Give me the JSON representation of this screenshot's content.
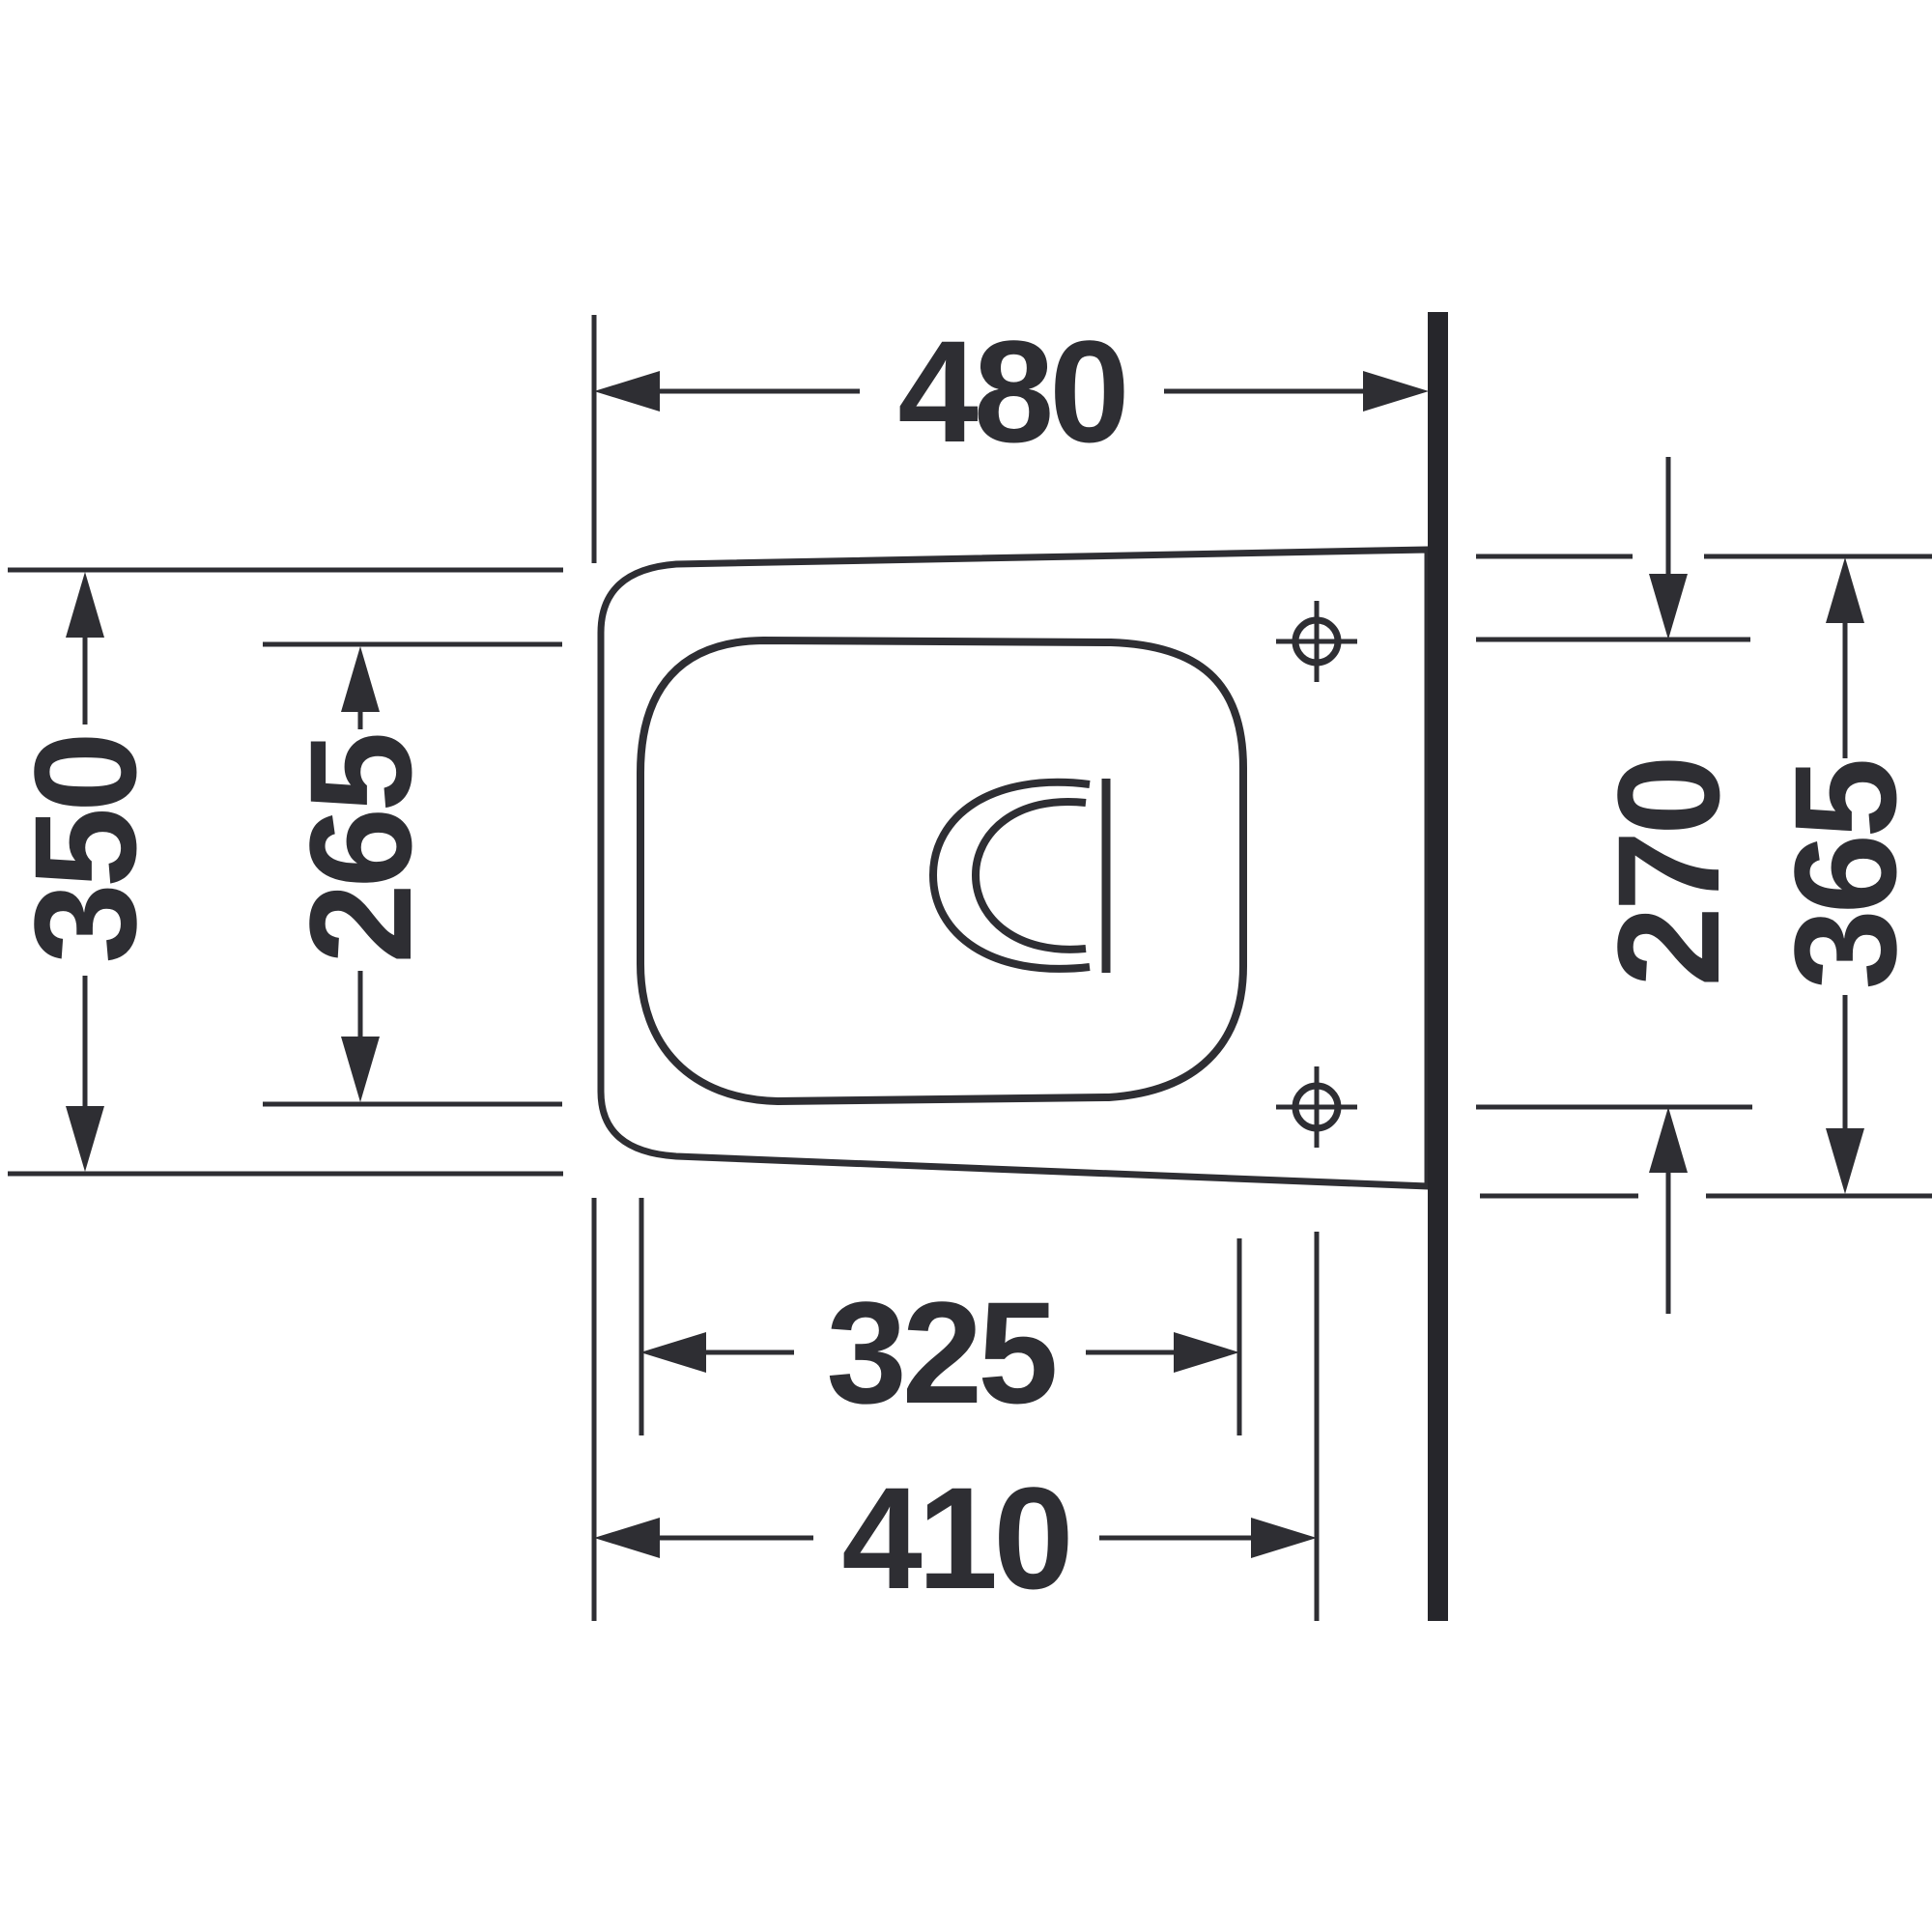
{
  "colors": {
    "line": "#2e2e33",
    "wall": "#26262b",
    "background": "#ffffff"
  },
  "dimensions": {
    "overall_depth": "480",
    "front_width": "350",
    "seat_opening_width": "265",
    "fixing_hole_spacing": "270",
    "rear_width": "365",
    "seat_opening_length": "325",
    "fixing_hole_distance_from_front": "410"
  }
}
